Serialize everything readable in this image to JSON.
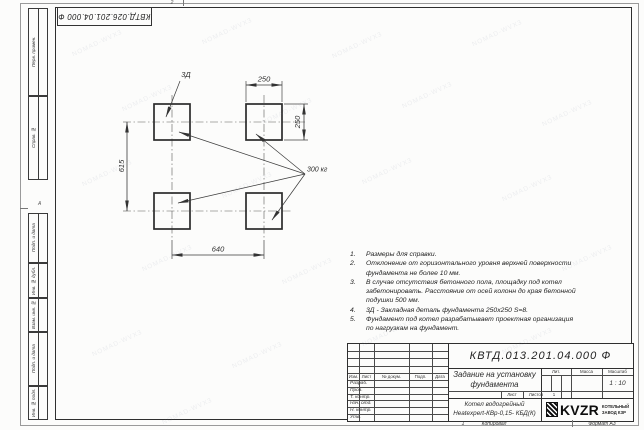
{
  "stamp_top": {
    "number": "КВТД.026.201.04.000 Ф"
  },
  "zones": {
    "top": "2",
    "left": "А"
  },
  "left_margin": [
    "Перв. примен.",
    "Справ. №",
    "Подп. и дата",
    "Инв. № дубл.",
    "Взам. инв. №",
    "Подп. и дата",
    "Инв. № подл."
  ],
  "drawing": {
    "detail_label": "3Д",
    "load_label": "300 кг",
    "dim_width_top": "250",
    "dim_height_right": "250",
    "dim_left": "615",
    "dim_bottom": "640"
  },
  "notes": {
    "items": [
      {
        "num": "1.",
        "text": "Размеры для справки."
      },
      {
        "num": "2.",
        "text": "Отклонение от горизонтального уровня верхней поверхности фундамента не более 10 мм."
      },
      {
        "num": "3.",
        "text": "В случае отсутствия бетонного пола, площадку под котел забетонировать. Расстояние от осей колонн до края бетонной подушки 500 мм."
      },
      {
        "num": "4.",
        "text": "3Д - Закладная деталь фундамента 250х250 S=8."
      },
      {
        "num": "5.",
        "text": "Фундамент под котел разрабатывает проектная организация по нагрузкам на фундамент."
      }
    ]
  },
  "title_block": {
    "doc_number": "КВТД.013.201.04.000 Ф",
    "title": "Задание на установку фундамента",
    "product": "Котел водогрейный Heatexpert-КВр-0,15- КБД(К)",
    "cols": [
      "Изм.",
      "Лист",
      "№ докум.",
      "Подп.",
      "Дата"
    ],
    "rows": [
      "Разраб.",
      "Пров.",
      "Т. контр.",
      "Нач. отд.",
      "Н. контр.",
      "Утв."
    ],
    "lit_label": "Лит.",
    "mass_label": "Масса",
    "scale_label": "Масштаб",
    "scale_value": "1 : 10",
    "sheet_label": "Лист",
    "sheets_label": "Листов",
    "sheets_value": "1",
    "logo_text": "KVZR",
    "logo_sub1": "КОТЕЛЬНЫЙ",
    "logo_sub2": "ЗАВОД КЗР"
  },
  "footer": {
    "num": "1",
    "copy": "Копировал",
    "format": "Формат А3"
  },
  "watermark": {
    "text": "NOMAD-WVX3"
  },
  "colors": {
    "line": "#3a3a3a",
    "paper": "#fcfcfb",
    "logo": "#111111"
  }
}
